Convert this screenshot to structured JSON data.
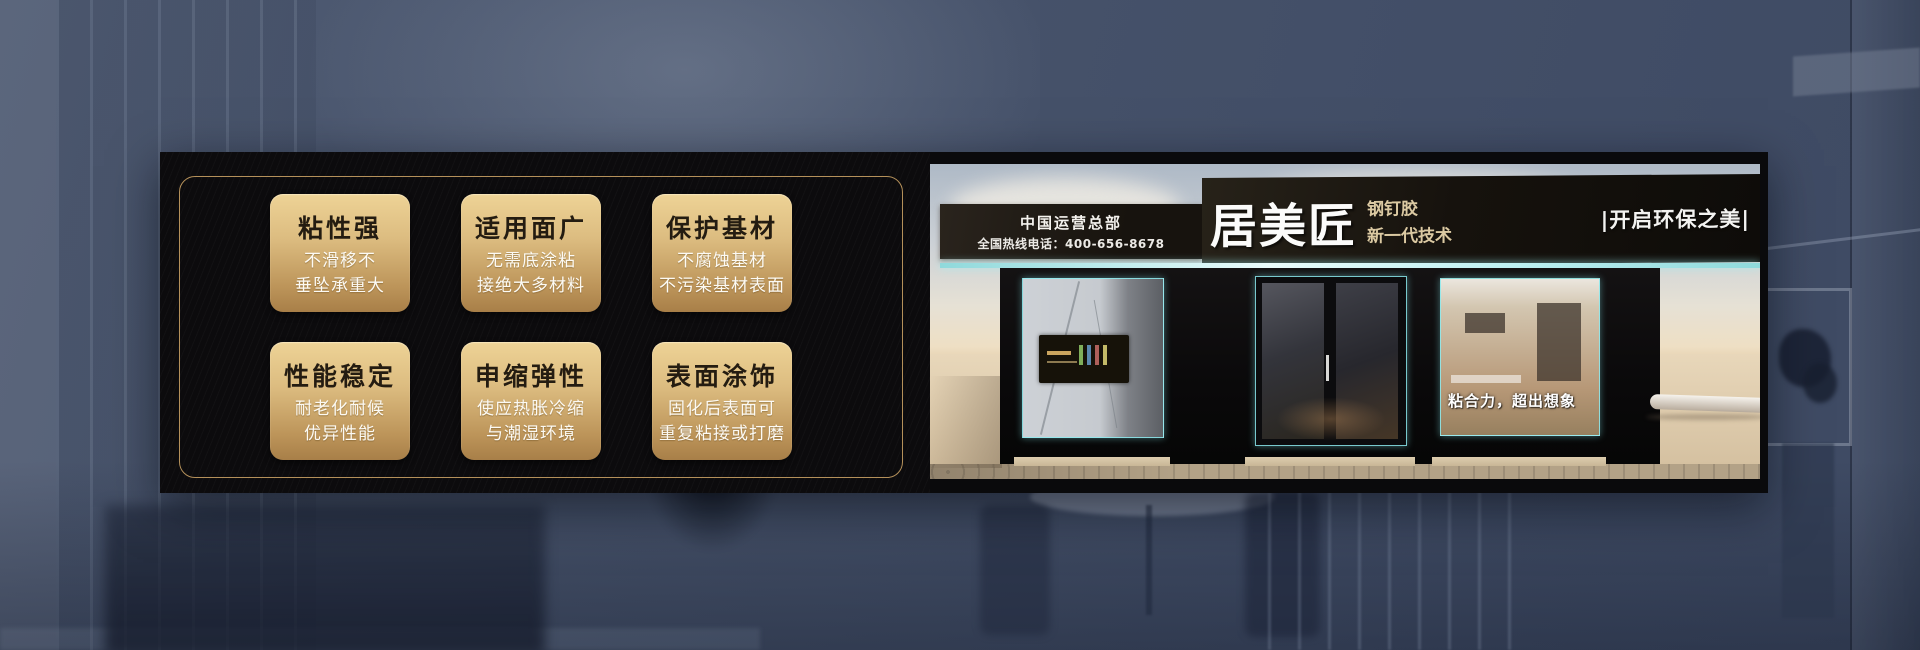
{
  "panel": {
    "cards": [
      {
        "title": "粘性强",
        "line1": "不滑移不",
        "line2": "垂坠承重大"
      },
      {
        "title": "适用面广",
        "line1": "无需底涂粘",
        "line2": "接绝大多材料"
      },
      {
        "title": "保护基材",
        "line1": "不腐蚀基材",
        "line2": "不污染基材表面"
      },
      {
        "title": "性能稳定",
        "line1": "耐老化耐候",
        "line2": "优异性能"
      },
      {
        "title": "申缩弹性",
        "line1": "使应热胀冷缩",
        "line2": "与潮湿环境"
      },
      {
        "title": "表面涂饰",
        "line1": "固化后表面可",
        "line2": "重复粘接或打磨"
      }
    ]
  },
  "storefront": {
    "hq_sign": {
      "line1": "中国运营总部",
      "line2": "全国热线电话：400-656-8678"
    },
    "brand_name": "居美匠",
    "product": "钢钉胶",
    "tagline": "新一代技术",
    "right_slogan": "|开启环保之美|",
    "window_slogan": "粘合力，超出想象"
  },
  "colors": {
    "background_blue": "#46526a",
    "panel_black": "#0a0a0c",
    "gold_border": "#b4905a",
    "card_gold_top": "#eed396",
    "card_gold_bottom": "#a87f48",
    "card_title_brown": "#241c11",
    "led_teal": "#8ee8ec",
    "sign_gold_text": "#dbc9a2"
  }
}
